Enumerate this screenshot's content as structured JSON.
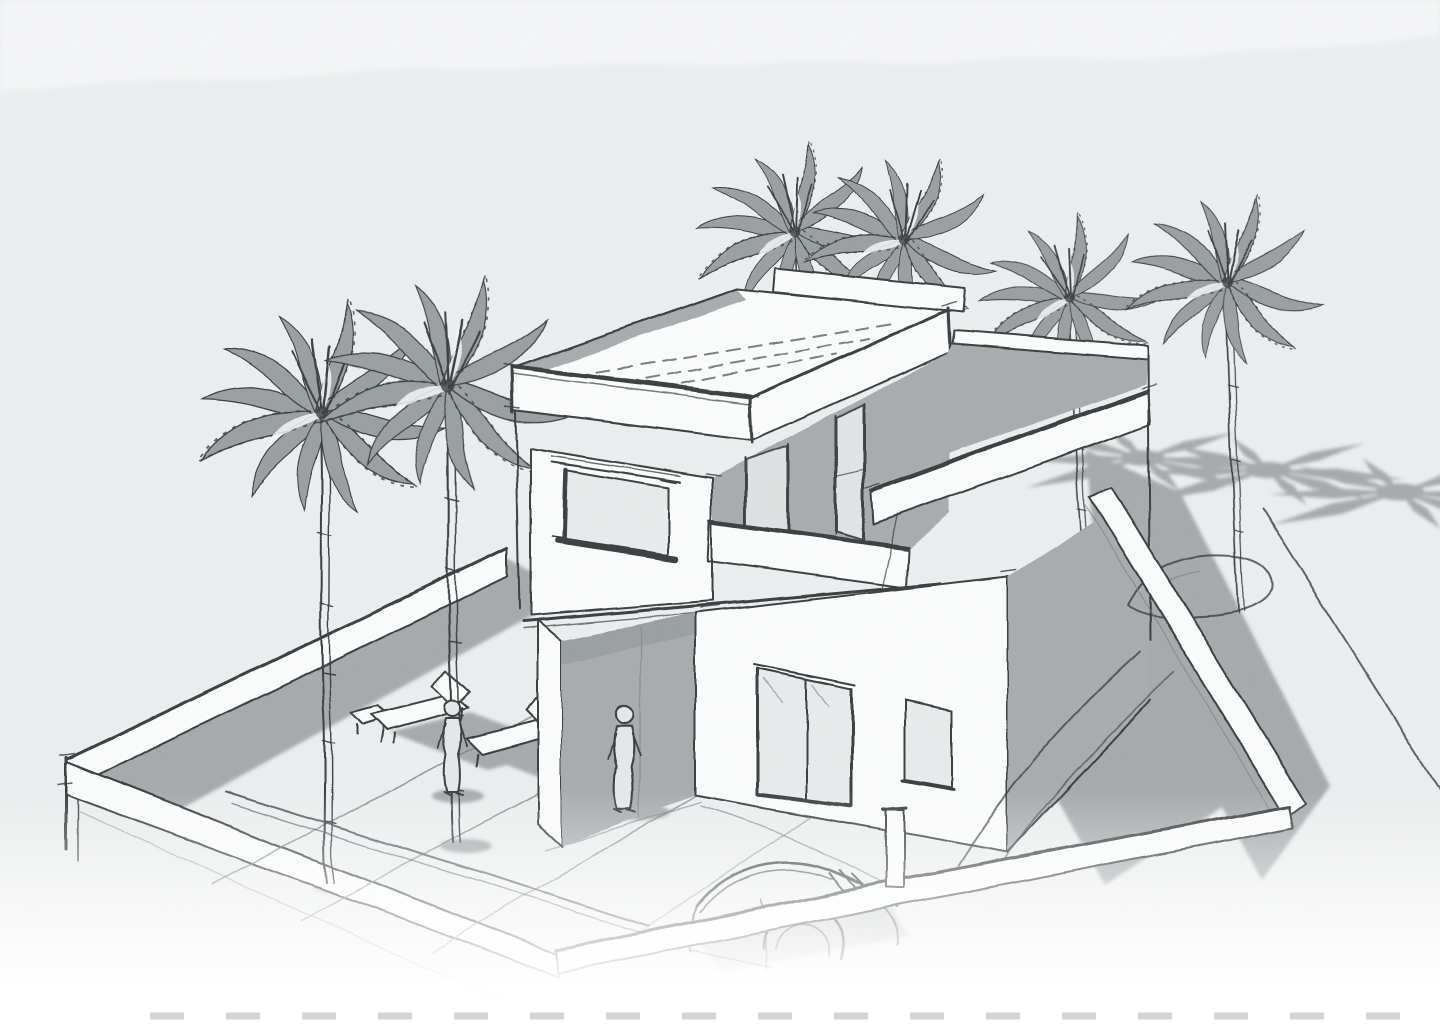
{
  "document": {
    "type_label": "Architectural concept sketch",
    "view_label": "Aerial perspective view of a walled villa plot",
    "subject_label": "Modern two-storey flat-roof villa with roof terrace, palm trees, courtyard, sun loungers, two figures and a parked car",
    "style_label": "Monochrome freehand pencil and marker sketch on textured paper"
  },
  "palette": {
    "paper": "#eceeef",
    "paper-light": "#f6f7f8",
    "white-face": "#fbfcfc",
    "gray-face": "#a9adaf",
    "gray-face-dark": "#9ba0a2",
    "shadow": "#a7abad",
    "glass": "#b4b8ba",
    "pane": "#e9ebec",
    "ink": "#3b3f42",
    "ink-light": "#7b8082",
    "dash": "#c6c9cb"
  },
  "scene": {
    "elements": {
      "house": {
        "label": "Modern two-storey villa with flat roof, cantilevered upper floor, balcony, picture window, glass entry doors and shaded porch"
      },
      "side_wing": {
        "label": "Single-storey side wing with roof terrace and parapet"
      },
      "palm_trees": {
        "label": "Palm trees",
        "count": 6
      },
      "palm_shadows": {
        "label": "Palm frond shadows cast on the street",
        "count": 3
      },
      "perimeter_wall": {
        "label": "Low perimeter wall around the plot"
      },
      "figures": {
        "label": "Standing human figures",
        "count": 2
      },
      "sun_loungers": {
        "label": "Sun loungers on the terrace",
        "count": 2
      },
      "car": {
        "label": "Sketched parked car at the driveway",
        "count": 1
      },
      "driveway": {
        "label": "Curved driveway lines and round planter"
      },
      "paving": {
        "label": "Terrace paving joint lines"
      }
    }
  }
}
